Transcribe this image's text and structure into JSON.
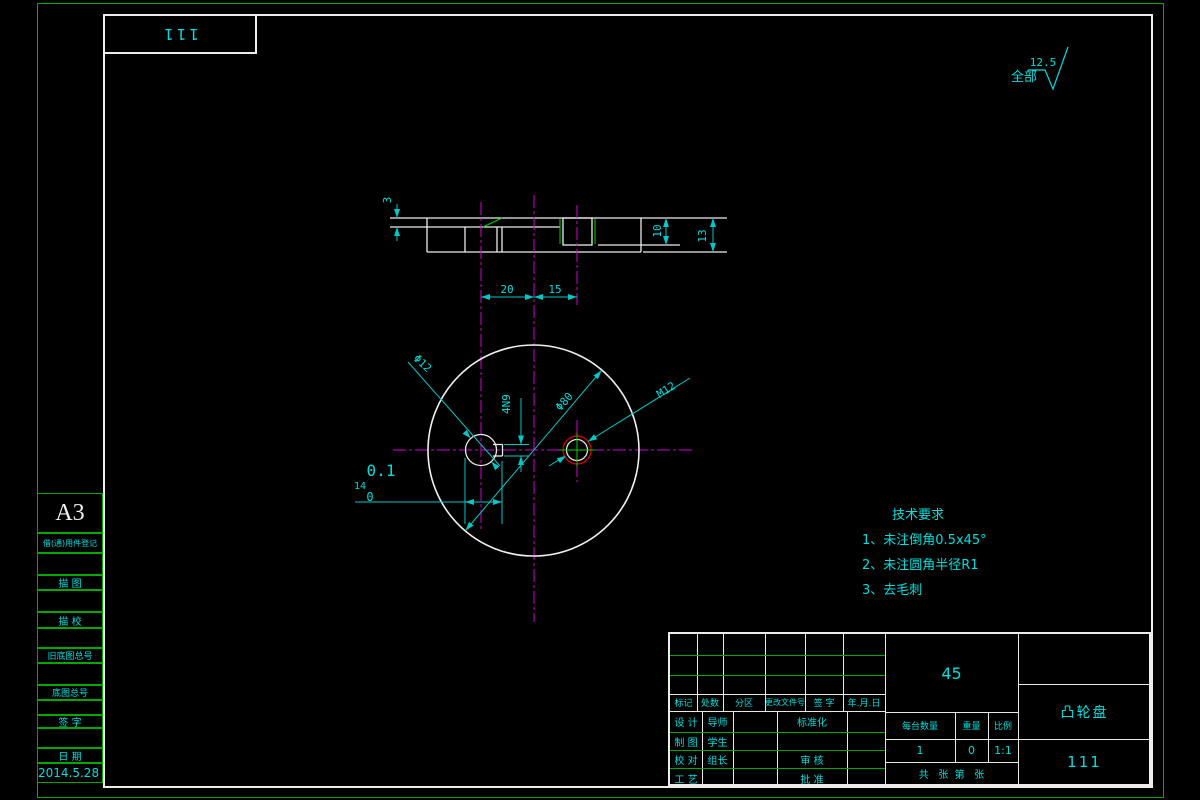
{
  "sheet": {
    "format": "A3",
    "top_box_text": "111",
    "date": "2014.5.28"
  },
  "finish": {
    "scope_label": "全部",
    "roughness": "12.5"
  },
  "sidebar": {
    "labels": [
      "借(通)用件登记",
      "描 图",
      "描 校",
      "旧底图总号",
      "底图总号",
      "签 字",
      "日 期"
    ]
  },
  "tech_req": {
    "title": "技术要求",
    "items": [
      "1、未注倒角0.5x45°",
      "2、未注圆角半径R1",
      "3、去毛刺"
    ]
  },
  "dims": {
    "d20": "20",
    "d15": "15",
    "d3": "3",
    "d10": "10",
    "d13": "13",
    "phi12": "Φ12",
    "phi80": "Φ80",
    "m12": "M12",
    "keyway": "4N9",
    "d14": "14",
    "d14_tol_up": "0.1",
    "d14_tol_low": "0"
  },
  "title_block": {
    "rev_header": [
      "标记",
      "处数",
      "分区",
      "更改文件号",
      "签 字",
      "年.月.日"
    ],
    "roles": [
      [
        "设 计",
        "导师"
      ],
      [
        "制 图",
        "学生"
      ],
      [
        "校 对",
        "组长"
      ],
      [
        "工 艺",
        ""
      ]
    ],
    "roles2": [
      "标准化",
      "",
      "审 核",
      "批 准"
    ],
    "material": "45",
    "part_name": "凸轮盘",
    "drawing_number": "111",
    "qty_header": [
      "每台数量",
      "重量",
      "比例"
    ],
    "qty_values": [
      "1",
      "0",
      "1:1"
    ],
    "sheet_note": "共   张  第   张"
  },
  "colors": {
    "background": "#000000",
    "outline_white": "#ececec",
    "annotation_cyan": "#00dede",
    "centerline_magenta": "#d400d4",
    "border_green": "#00af00",
    "thread_red": "#c80000",
    "thread_green": "#00d000"
  }
}
